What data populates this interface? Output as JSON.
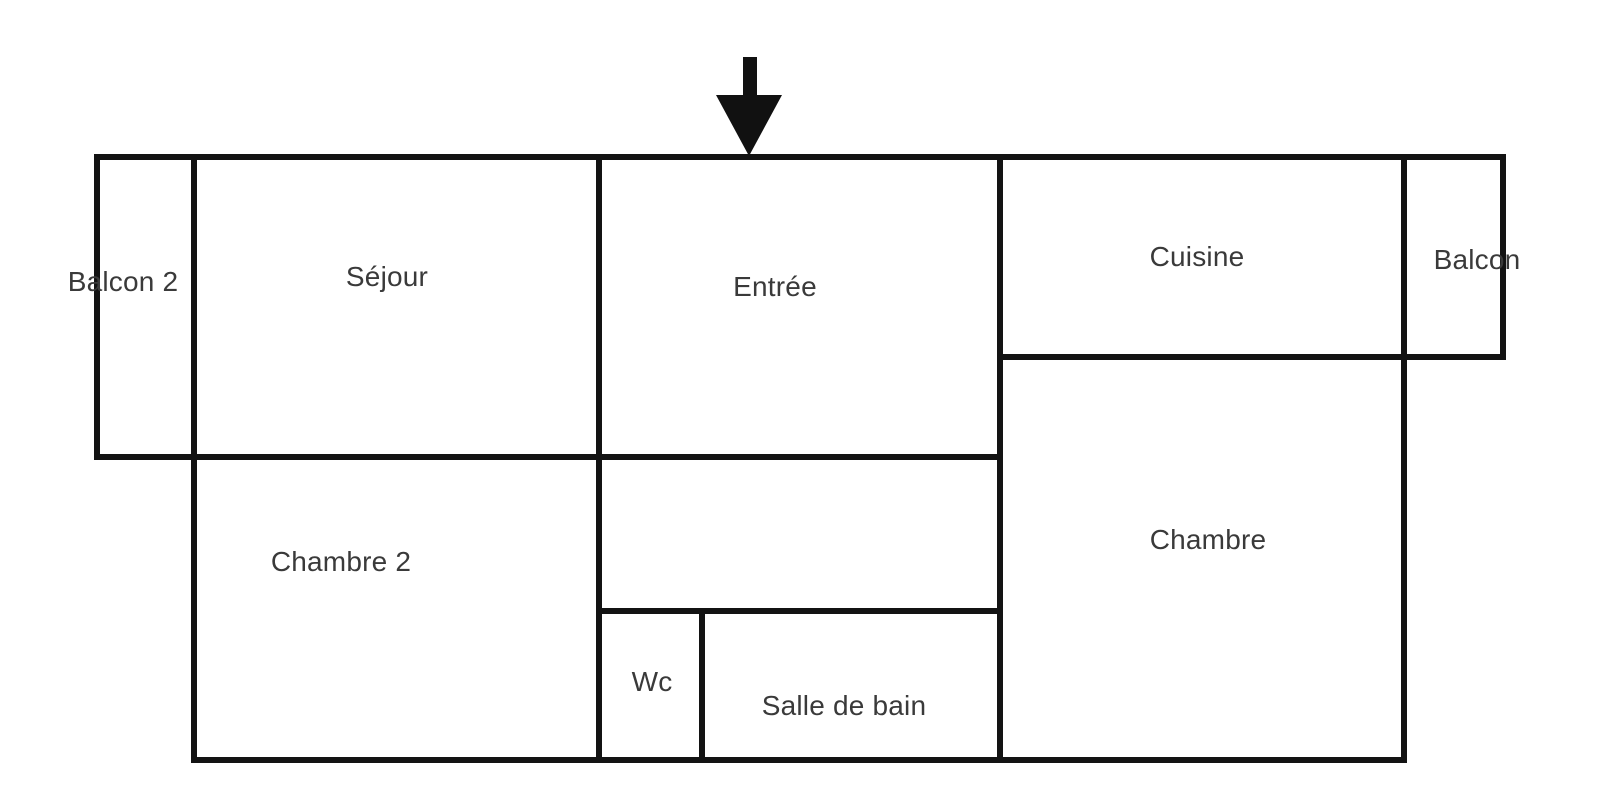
{
  "page": {
    "background_color": "#ffffff"
  },
  "floor_plan": {
    "wall_color": "#131313",
    "label_color": "#3a3a3a",
    "arrow_icon": "down-arrow-icon"
  },
  "rooms": [
    {
      "id": "balcon-2",
      "label": "Balcon 2"
    },
    {
      "id": "sejour",
      "label": "Séjour"
    },
    {
      "id": "entree",
      "label": "Entrée"
    },
    {
      "id": "cuisine",
      "label": "Cuisine"
    },
    {
      "id": "balcon",
      "label": "Balcon"
    },
    {
      "id": "chambre-2",
      "label": "Chambre 2"
    },
    {
      "id": "wc",
      "label": "Wc"
    },
    {
      "id": "salle-de-bain",
      "label": "Salle de bain"
    },
    {
      "id": "chambre",
      "label": "Chambre"
    }
  ]
}
